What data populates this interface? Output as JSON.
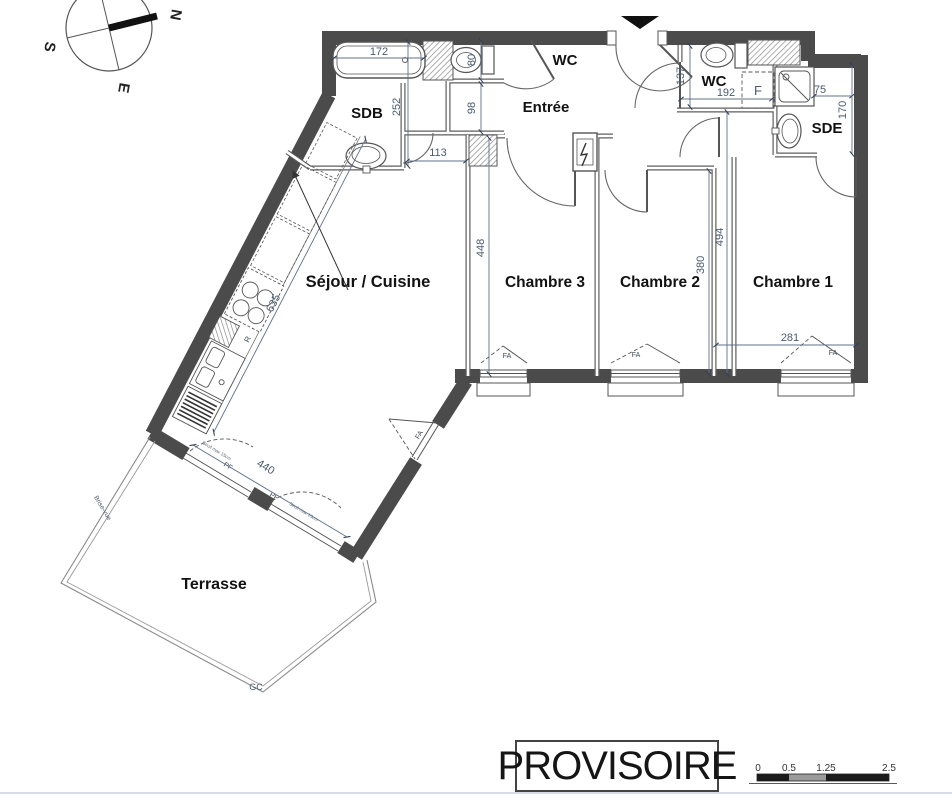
{
  "plan": {
    "rooms": {
      "sdb": "SDB",
      "wc1": "WC",
      "entree": "Entrée",
      "wc2": "WC",
      "sde": "SDE",
      "sejour": "Séjour / Cuisine",
      "chambre3": "Chambre 3",
      "chambre2": "Chambre 2",
      "chambre1": "Chambre 1",
      "terrasse": "Terrasse"
    },
    "dimensions": {
      "bathtub_length": "172",
      "sdb_height": "252",
      "sdb_passage": "113",
      "wc1_width": "80",
      "passage_width": "98",
      "wc2_depth": "137",
      "wc2_width": "192",
      "sde_shower": "75",
      "sde_height": "170",
      "chambre3_depth": "448",
      "chambre2_depth": "380",
      "chambre1_depth": "494",
      "chambre1_width": "281",
      "kitchen_wall": "635",
      "bay_width": "440"
    },
    "tags": {
      "window_fa": "FA",
      "window_pf": "PF",
      "closet_f": "F",
      "fridge_r": "R",
      "terrace_gc": "GC",
      "threshold_note": "Seuil max 15cm",
      "screen_note": "Brise-vue"
    },
    "compass": {
      "north": "N",
      "south": "S",
      "east": "E"
    },
    "stamp": "PROVISOIRE",
    "scale_bar": {
      "labels": [
        "0",
        "0.5",
        "1.25",
        "2.5"
      ]
    },
    "colors": {
      "wall": "#4b4b4b",
      "dim_text": "#4a5a6e",
      "label_text": "#121212"
    }
  }
}
